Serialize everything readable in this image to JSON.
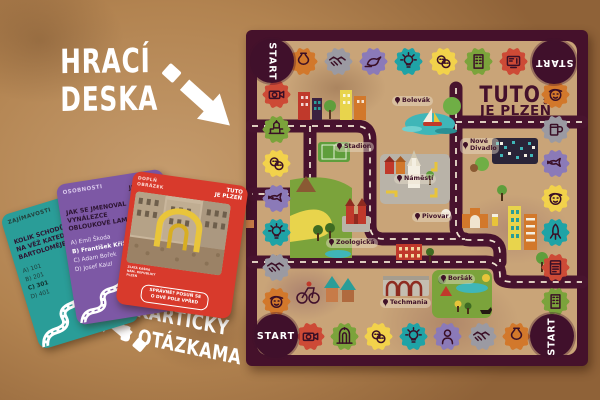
{
  "annotations": {
    "board_label_line1": "HRACÍ",
    "board_label_line2": "DESKA",
    "cards_label_line1": "KARTIČKY",
    "cards_label_line2": "S OTÁZKAMA"
  },
  "board": {
    "logo_line1": "TUTO",
    "logo_arrow": "↓",
    "logo_line2": "JE PLZEŇ",
    "start_label": "START",
    "locations": [
      "Bolevák",
      "Stadion",
      "Náměstí",
      "Nové Divadlo",
      "Pivovar",
      "Zoologická",
      "Boršák",
      "Techmania"
    ],
    "space_colors": {
      "orange": "#d2782b",
      "gray": "#9b9aa2",
      "purple": "#8b7ab8",
      "teal": "#1fa3a6",
      "yellow": "#f2d24b",
      "green": "#7ba33b",
      "red": "#cd4a36",
      "maroon": "#40102b"
    },
    "spaces": {
      "top": [
        {
          "color": "orange",
          "icon": "vase"
        },
        {
          "color": "gray",
          "icon": "handshake"
        },
        {
          "color": "purple",
          "icon": "bird"
        },
        {
          "color": "teal",
          "icon": "bulb"
        },
        {
          "color": "yellow",
          "icon": "masks"
        },
        {
          "color": "green",
          "icon": "building"
        },
        {
          "color": "red",
          "icon": "tv"
        }
      ],
      "right": [
        {
          "color": "orange",
          "icon": "face"
        },
        {
          "color": "gray",
          "icon": "mug"
        },
        {
          "color": "purple",
          "icon": "fish"
        },
        {
          "color": "yellow",
          "icon": "face"
        },
        {
          "color": "teal",
          "icon": "rocket"
        },
        {
          "color": "red",
          "icon": "book"
        },
        {
          "color": "green",
          "icon": "building"
        }
      ],
      "bottom": [
        {
          "color": "red",
          "icon": "camera"
        },
        {
          "color": "green",
          "icon": "gate"
        },
        {
          "color": "yellow",
          "icon": "masks"
        },
        {
          "color": "teal",
          "icon": "bulb"
        },
        {
          "color": "purple",
          "icon": "person"
        },
        {
          "color": "gray",
          "icon": "handshake"
        },
        {
          "color": "orange",
          "icon": "vase"
        }
      ],
      "left": [
        {
          "color": "red",
          "icon": "camera"
        },
        {
          "color": "green",
          "icon": "church"
        },
        {
          "color": "yellow",
          "icon": "masks"
        },
        {
          "color": "purple",
          "icon": "fish"
        },
        {
          "color": "teal",
          "icon": "bulb"
        },
        {
          "color": "gray",
          "icon": "handshake"
        },
        {
          "color": "orange",
          "icon": "face"
        }
      ]
    }
  },
  "cards": {
    "teal": {
      "category": "ZAJÍMAVOSTI",
      "logo_line1": "TUTO",
      "logo_line2": "JE PLZEŇ",
      "question": "KOLIK SCHODŮ VEDE NA VĚŽ KATEDRÁLY SV. BARTOLOMĚJE?",
      "answers": [
        "A) 101",
        "B) 201",
        "C) 301",
        "D) 401"
      ],
      "highlight": 2
    },
    "purple": {
      "category": "OSOBNOSTI",
      "logo_line1": "TUTO",
      "logo_line2": "JE PLZEŇ",
      "question": "JAK SE JMENOVAL VYNÁLEZCE OBLOUKOVÉ LAMPY?",
      "answers": [
        "A) Emil Škoda",
        "B) František Křižík",
        "C) Adam Bořek",
        "D) Josef Kaizl"
      ],
      "highlight": 1,
      "note_lines": [
        "JEĎ",
        "O POLE",
        "VPŘED"
      ]
    },
    "red": {
      "category_line1": "DOPLŇ",
      "category_line2": "OBRÁZEK",
      "logo_line1": "TUTO",
      "logo_line2": "JE PLZEŇ",
      "caption_lines": [
        "ZLATÁ KAŠNA",
        "NÁM. REPUBLIKY",
        "PLZEŇ"
      ],
      "footer_line1": "SPRÁVNĚ? POSUŇ SE",
      "footer_line2": "O DVĚ POLE VPŘED"
    }
  }
}
